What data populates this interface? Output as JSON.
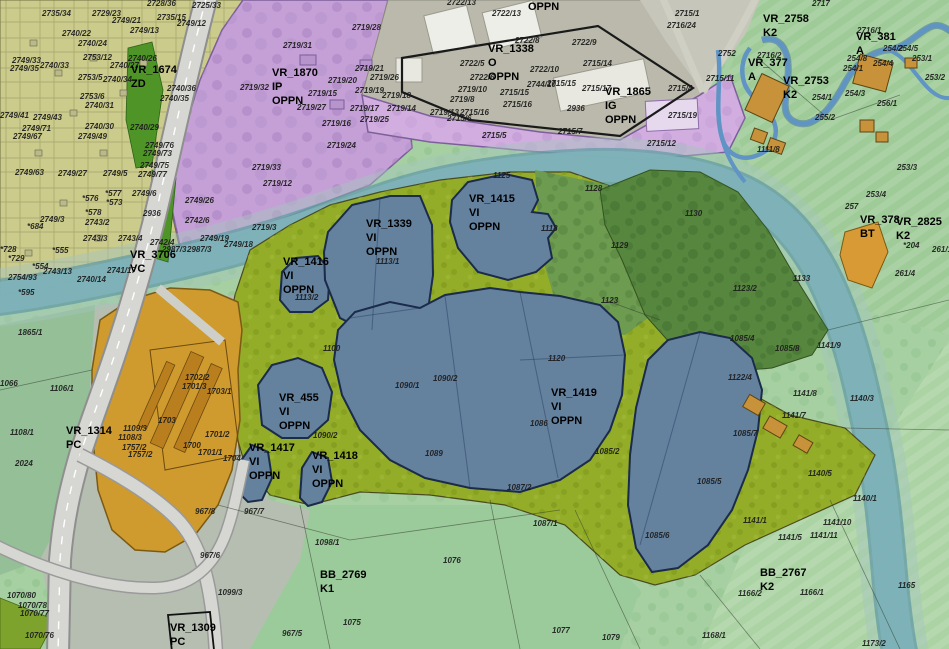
{
  "map_type": "municipal zoning / cadastral plan with land-use zones, gravel-pit lakes, river and highway",
  "colors": {
    "residential_yellow": "#cbcb8c",
    "industrial_purple": "#c4a0d6",
    "industrial_light_purple": "#d2aee0",
    "industrial_gray": "#bab9ab",
    "lake_blue": "#64819e",
    "lake_border": "#1b2b4a",
    "river_teal": "#7fb2ba",
    "recultivation_olive": "#93ad28",
    "forest_dark": "#57863f",
    "quarry_orange": "#cf9a2e",
    "fields_green": "#a6cfa2",
    "green_strip": "#4e9427",
    "road_gray": "#d6d6d2",
    "buildings_tan": "#c8923a"
  },
  "planning_units": [
    {
      "code": "VR_1674",
      "designation": "ZD"
    },
    {
      "code": "VR_3706",
      "designation": "VC"
    },
    {
      "code": "VR_1870",
      "designation": "IP OPPN"
    },
    {
      "code": "VR_1338",
      "designation": "O OPPN"
    },
    {
      "code": "VR_1865",
      "designation": "IG OPPN"
    },
    {
      "code": "VR_2758",
      "designation": "K2"
    },
    {
      "code": "VR_381",
      "designation": "A"
    },
    {
      "code": "VR_377",
      "designation": "A"
    },
    {
      "code": "VR_2753",
      "designation": "K2"
    },
    {
      "code": "VR_378",
      "designation": "BT"
    },
    {
      "code": "VR_2825",
      "designation": "K2"
    },
    {
      "code": "VR_1416",
      "designation": "VI OPPN"
    },
    {
      "code": "VR_1339",
      "designation": "VI OPPN"
    },
    {
      "code": "VR_1415",
      "designation": "VI OPPN"
    },
    {
      "code": "VR_455",
      "designation": "VI OPPN"
    },
    {
      "code": "VR_1417",
      "designation": "VI OPPN"
    },
    {
      "code": "VR_1418",
      "designation": "VI OPPN"
    },
    {
      "code": "VR_1419",
      "designation": "VI OPPN"
    },
    {
      "code": "VR_1314",
      "designation": "PC"
    },
    {
      "code": "VR_1309",
      "designation": "PC"
    },
    {
      "code": "BB_2769",
      "designation": "K1"
    },
    {
      "code": "BB_2767",
      "designation": "K2"
    }
  ],
  "zone_labels": [
    {
      "lines": [
        "VR_1674",
        "ZD"
      ],
      "x": 131,
      "y": 73
    },
    {
      "lines": [
        "VR_3706",
        "VC"
      ],
      "x": 130,
      "y": 258
    },
    {
      "lines": [
        "VR_1870",
        "IP",
        "OPPN"
      ],
      "x": 272,
      "y": 76
    },
    {
      "lines": [
        "VR_1338",
        "O",
        "OPPN"
      ],
      "x": 488,
      "y": 52
    },
    {
      "lines": [
        "OPPN"
      ],
      "x": 528,
      "y": 10
    },
    {
      "lines": [
        "VR_1865",
        "IG",
        "OPPN"
      ],
      "x": 605,
      "y": 95
    },
    {
      "lines": [
        "VR_2758",
        "K2"
      ],
      "x": 763,
      "y": 22
    },
    {
      "lines": [
        "VR_381",
        "A"
      ],
      "x": 856,
      "y": 40
    },
    {
      "lines": [
        "VR_377",
        "A"
      ],
      "x": 748,
      "y": 66
    },
    {
      "lines": [
        "VR_2753",
        "K2"
      ],
      "x": 783,
      "y": 84
    },
    {
      "lines": [
        "VR_378",
        "BT"
      ],
      "x": 860,
      "y": 223
    },
    {
      "lines": [
        "VR_2825",
        "K2"
      ],
      "x": 896,
      "y": 225
    },
    {
      "lines": [
        "VR_1416",
        "VI",
        "OPPN"
      ],
      "x": 283,
      "y": 265
    },
    {
      "lines": [
        "VR_1339",
        "VI",
        "OPPN"
      ],
      "x": 366,
      "y": 227
    },
    {
      "lines": [
        "VR_1415",
        "VI",
        "OPPN"
      ],
      "x": 469,
      "y": 202
    },
    {
      "lines": [
        "VR_455",
        "VI",
        "OPPN"
      ],
      "x": 279,
      "y": 401
    },
    {
      "lines": [
        "VR_1417",
        "VI",
        "OPPN"
      ],
      "x": 249,
      "y": 451
    },
    {
      "lines": [
        "VR_1418",
        "VI",
        "OPPN"
      ],
      "x": 312,
      "y": 459
    },
    {
      "lines": [
        "VR_1419",
        "VI",
        "OPPN"
      ],
      "x": 551,
      "y": 396
    },
    {
      "lines": [
        "VR_1314",
        "PC"
      ],
      "x": 66,
      "y": 434
    },
    {
      "lines": [
        "VR_1309",
        "PC"
      ],
      "x": 170,
      "y": 631
    },
    {
      "lines": [
        "BB_2769",
        "K1"
      ],
      "x": 320,
      "y": 578
    },
    {
      "lines": [
        "BB_2767",
        "K2"
      ],
      "x": 760,
      "y": 576
    }
  ],
  "parcel_labels": [
    {
      "t": "2728/36",
      "x": 147,
      "y": 6
    },
    {
      "t": "2725/33",
      "x": 192,
      "y": 8
    },
    {
      "t": "2735/34",
      "x": 42,
      "y": 16
    },
    {
      "t": "2729/23",
      "x": 92,
      "y": 16
    },
    {
      "t": "2749/21",
      "x": 112,
      "y": 23
    },
    {
      "t": "2735/15",
      "x": 157,
      "y": 20
    },
    {
      "t": "2749/12",
      "x": 177,
      "y": 26
    },
    {
      "t": "2749/13",
      "x": 130,
      "y": 33
    },
    {
      "t": "2740/22",
      "x": 62,
      "y": 36
    },
    {
      "t": "2740/24",
      "x": 78,
      "y": 46
    },
    {
      "t": "2753/12",
      "x": 83,
      "y": 60
    },
    {
      "t": "2740/26",
      "x": 128,
      "y": 61
    },
    {
      "t": "2740/27",
      "x": 110,
      "y": 68
    },
    {
      "t": "2740/33",
      "x": 40,
      "y": 68
    },
    {
      "t": "2749/33",
      "x": 12,
      "y": 63
    },
    {
      "t": "2749/35",
      "x": 10,
      "y": 71
    },
    {
      "t": "2753/5",
      "x": 78,
      "y": 80
    },
    {
      "t": "2740/34",
      "x": 103,
      "y": 82
    },
    {
      "t": "2740/36",
      "x": 167,
      "y": 91
    },
    {
      "t": "2740/35",
      "x": 160,
      "y": 101
    },
    {
      "t": "2753/6",
      "x": 80,
      "y": 99
    },
    {
      "t": "2740/31",
      "x": 85,
      "y": 108
    },
    {
      "t": "2749/43",
      "x": 33,
      "y": 120
    },
    {
      "t": "2749/41",
      "x": 0,
      "y": 118
    },
    {
      "t": "2740/30",
      "x": 85,
      "y": 129
    },
    {
      "t": "2749/71",
      "x": 22,
      "y": 131
    },
    {
      "t": "2749/67",
      "x": 13,
      "y": 139
    },
    {
      "t": "2749/49",
      "x": 78,
      "y": 139
    },
    {
      "t": "2740/29",
      "x": 130,
      "y": 130
    },
    {
      "t": "2749/76",
      "x": 145,
      "y": 148
    },
    {
      "t": "2749/73",
      "x": 143,
      "y": 156
    },
    {
      "t": "2749/63",
      "x": 15,
      "y": 175
    },
    {
      "t": "2749/27",
      "x": 58,
      "y": 176
    },
    {
      "t": "2749/5",
      "x": 103,
      "y": 176
    },
    {
      "t": "2749/75",
      "x": 140,
      "y": 168
    },
    {
      "t": "2749/77",
      "x": 138,
      "y": 177
    },
    {
      "t": "2749/6",
      "x": 132,
      "y": 196
    },
    {
      "t": "*577",
      "x": 105,
      "y": 196
    },
    {
      "t": "*576",
      "x": 82,
      "y": 201
    },
    {
      "t": "*573",
      "x": 106,
      "y": 205
    },
    {
      "t": "*578",
      "x": 85,
      "y": 215
    },
    {
      "t": "2749/3",
      "x": 40,
      "y": 222
    },
    {
      "t": "*684",
      "x": 27,
      "y": 229
    },
    {
      "t": "2743/2",
      "x": 85,
      "y": 225
    },
    {
      "t": "2743/3",
      "x": 83,
      "y": 241
    },
    {
      "t": "2743/4",
      "x": 118,
      "y": 241
    },
    {
      "t": "2742/4",
      "x": 150,
      "y": 245
    },
    {
      "t": "2936",
      "x": 143,
      "y": 216
    },
    {
      "t": "*555",
      "x": 52,
      "y": 253
    },
    {
      "t": "*728",
      "x": 0,
      "y": 252
    },
    {
      "t": "*729",
      "x": 8,
      "y": 261
    },
    {
      "t": "*554",
      "x": 32,
      "y": 269
    },
    {
      "t": "2741/17",
      "x": 107,
      "y": 273
    },
    {
      "t": "2740/14",
      "x": 77,
      "y": 282
    },
    {
      "t": "2754/93",
      "x": 8,
      "y": 280
    },
    {
      "t": "2743/13",
      "x": 43,
      "y": 274
    },
    {
      "t": "*595",
      "x": 18,
      "y": 295
    },
    {
      "t": "2719/33",
      "x": 252,
      "y": 170
    },
    {
      "t": "2719/12",
      "x": 263,
      "y": 186
    },
    {
      "t": "2749/26",
      "x": 185,
      "y": 203
    },
    {
      "t": "2742/6",
      "x": 185,
      "y": 223
    },
    {
      "t": "2719/3",
      "x": 252,
      "y": 230
    },
    {
      "t": "2749/19",
      "x": 200,
      "y": 241
    },
    {
      "t": "2749/18",
      "x": 224,
      "y": 247
    },
    {
      "t": "2987/3",
      "x": 162,
      "y": 252
    },
    {
      "t": "2987/3",
      "x": 187,
      "y": 252
    },
    {
      "t": "2719/31",
      "x": 283,
      "y": 48
    },
    {
      "t": "2719/32",
      "x": 240,
      "y": 90
    },
    {
      "t": "2719/28",
      "x": 352,
      "y": 30
    },
    {
      "t": "2719/21",
      "x": 355,
      "y": 71
    },
    {
      "t": "2719/26",
      "x": 370,
      "y": 80
    },
    {
      "t": "2719/20",
      "x": 328,
      "y": 83
    },
    {
      "t": "2719/15",
      "x": 308,
      "y": 96
    },
    {
      "t": "2719/19",
      "x": 355,
      "y": 93
    },
    {
      "t": "2719/18",
      "x": 382,
      "y": 98
    },
    {
      "t": "2719/27",
      "x": 297,
      "y": 110
    },
    {
      "t": "2719/17",
      "x": 350,
      "y": 111
    },
    {
      "t": "2719/14",
      "x": 387,
      "y": 111
    },
    {
      "t": "2719/16",
      "x": 322,
      "y": 126
    },
    {
      "t": "2719/25",
      "x": 360,
      "y": 122
    },
    {
      "t": "2719/24",
      "x": 327,
      "y": 148
    },
    {
      "t": "2722/13",
      "x": 447,
      "y": 5
    },
    {
      "t": "2722/13",
      "x": 492,
      "y": 16
    },
    {
      "t": "2722/8",
      "x": 515,
      "y": 43
    },
    {
      "t": "2722/9",
      "x": 572,
      "y": 45
    },
    {
      "t": "2722/5",
      "x": 460,
      "y": 66
    },
    {
      "t": "2722/6",
      "x": 470,
      "y": 80
    },
    {
      "t": "2722/10",
      "x": 530,
      "y": 72
    },
    {
      "t": "2715/14",
      "x": 583,
      "y": 66
    },
    {
      "t": "2715/15",
      "x": 547,
      "y": 86
    },
    {
      "t": "2744/10",
      "x": 527,
      "y": 87
    },
    {
      "t": "2719/10",
      "x": 458,
      "y": 92
    },
    {
      "t": "2719/8",
      "x": 450,
      "y": 102
    },
    {
      "t": "2719/13",
      "x": 430,
      "y": 115
    },
    {
      "t": "2715/16",
      "x": 460,
      "y": 115
    },
    {
      "t": "2715/6",
      "x": 447,
      "y": 121
    },
    {
      "t": "2715/16",
      "x": 503,
      "y": 107
    },
    {
      "t": "2936",
      "x": 567,
      "y": 111
    },
    {
      "t": "2715/5",
      "x": 482,
      "y": 138
    },
    {
      "t": "2715/7",
      "x": 558,
      "y": 134
    },
    {
      "t": "2715/17",
      "x": 582,
      "y": 91
    },
    {
      "t": "2715/15",
      "x": 500,
      "y": 95
    },
    {
      "t": "2715/4",
      "x": 668,
      "y": 91
    },
    {
      "t": "2715/19",
      "x": 668,
      "y": 118
    },
    {
      "t": "2715/12",
      "x": 647,
      "y": 146
    },
    {
      "t": "2715/11",
      "x": 706,
      "y": 81
    },
    {
      "t": "2715/1",
      "x": 675,
      "y": 16
    },
    {
      "t": "2716/24",
      "x": 667,
      "y": 28
    },
    {
      "t": "2717",
      "x": 812,
      "y": 6
    },
    {
      "t": "2716/1",
      "x": 857,
      "y": 33
    },
    {
      "t": "2716/2",
      "x": 757,
      "y": 58
    },
    {
      "t": "2752",
      "x": 718,
      "y": 56
    },
    {
      "t": "254/2",
      "x": 883,
      "y": 51
    },
    {
      "t": "254/5",
      "x": 898,
      "y": 51
    },
    {
      "t": "254/8",
      "x": 847,
      "y": 61
    },
    {
      "t": "254/4",
      "x": 873,
      "y": 66
    },
    {
      "t": "253/1",
      "x": 912,
      "y": 61
    },
    {
      "t": "253/2",
      "x": 925,
      "y": 80
    },
    {
      "t": "254/1",
      "x": 843,
      "y": 71
    },
    {
      "t": "254/3",
      "x": 845,
      "y": 96
    },
    {
      "t": "254/1",
      "x": 812,
      "y": 100
    },
    {
      "t": "256/1",
      "x": 877,
      "y": 106
    },
    {
      "t": "255/2",
      "x": 815,
      "y": 120
    },
    {
      "t": "1111/8",
      "x": 757,
      "y": 152
    },
    {
      "t": "253/3",
      "x": 897,
      "y": 170
    },
    {
      "t": "253/4",
      "x": 866,
      "y": 197
    },
    {
      "t": "257",
      "x": 845,
      "y": 209
    },
    {
      "t": "*204",
      "x": 903,
      "y": 248
    },
    {
      "t": "261/4",
      "x": 895,
      "y": 276
    },
    {
      "t": "261/1",
      "x": 932,
      "y": 252
    },
    {
      "t": "1130",
      "x": 685,
      "y": 216
    },
    {
      "t": "1133",
      "x": 793,
      "y": 281
    },
    {
      "t": "1123/2",
      "x": 733,
      "y": 291
    },
    {
      "t": "1123",
      "x": 601,
      "y": 303
    },
    {
      "t": "1129",
      "x": 611,
      "y": 248
    },
    {
      "t": "1128",
      "x": 585,
      "y": 191
    },
    {
      "t": "1118",
      "x": 541,
      "y": 231
    },
    {
      "t": "1125",
      "x": 493,
      "y": 178
    },
    {
      "t": "1113/1",
      "x": 376,
      "y": 264
    },
    {
      "t": "1113/2",
      "x": 295,
      "y": 300
    },
    {
      "t": "1100",
      "x": 323,
      "y": 351
    },
    {
      "t": "1090/1",
      "x": 395,
      "y": 388
    },
    {
      "t": "1090/2",
      "x": 433,
      "y": 381
    },
    {
      "t": "1120",
      "x": 548,
      "y": 361
    },
    {
      "t": "1086",
      "x": 530,
      "y": 426
    },
    {
      "t": "1089",
      "x": 425,
      "y": 456
    },
    {
      "t": "1090/2",
      "x": 313,
      "y": 438
    },
    {
      "t": "1085/2",
      "x": 595,
      "y": 454
    },
    {
      "t": "1087/2",
      "x": 507,
      "y": 490
    },
    {
      "t": "1122/4",
      "x": 728,
      "y": 380
    },
    {
      "t": "1085/7",
      "x": 733,
      "y": 436
    },
    {
      "t": "1085/5",
      "x": 697,
      "y": 484
    },
    {
      "t": "1085/4",
      "x": 730,
      "y": 341
    },
    {
      "t": "1085/8",
      "x": 775,
      "y": 351
    },
    {
      "t": "1141/9",
      "x": 817,
      "y": 348
    },
    {
      "t": "1141/8",
      "x": 793,
      "y": 396
    },
    {
      "t": "1141/7",
      "x": 782,
      "y": 418
    },
    {
      "t": "1140/3",
      "x": 850,
      "y": 401
    },
    {
      "t": "1140/5",
      "x": 808,
      "y": 476
    },
    {
      "t": "1085/6",
      "x": 645,
      "y": 538
    },
    {
      "t": "1140/1",
      "x": 853,
      "y": 501
    },
    {
      "t": "1141/10",
      "x": 823,
      "y": 525
    },
    {
      "t": "1141/5",
      "x": 778,
      "y": 540
    },
    {
      "t": "1141/11",
      "x": 810,
      "y": 538
    },
    {
      "t": "1141/1",
      "x": 743,
      "y": 523
    },
    {
      "t": "1166/2",
      "x": 738,
      "y": 596
    },
    {
      "t": "1166/1",
      "x": 800,
      "y": 595
    },
    {
      "t": "1165",
      "x": 898,
      "y": 588
    },
    {
      "t": "1168/1",
      "x": 702,
      "y": 638
    },
    {
      "t": "1173/2",
      "x": 862,
      "y": 646
    },
    {
      "t": "1098/1",
      "x": 315,
      "y": 545
    },
    {
      "t": "1076",
      "x": 443,
      "y": 563
    },
    {
      "t": "1075",
      "x": 343,
      "y": 625
    },
    {
      "t": "1087/1",
      "x": 533,
      "y": 526
    },
    {
      "t": "1077",
      "x": 552,
      "y": 633
    },
    {
      "t": "1079",
      "x": 602,
      "y": 640
    },
    {
      "t": "967/8",
      "x": 195,
      "y": 514
    },
    {
      "t": "967/7",
      "x": 244,
      "y": 514
    },
    {
      "t": "967/6",
      "x": 200,
      "y": 558
    },
    {
      "t": "1099/3",
      "x": 218,
      "y": 595
    },
    {
      "t": "967/5",
      "x": 282,
      "y": 636
    },
    {
      "t": "1070/80",
      "x": 7,
      "y": 598
    },
    {
      "t": "1070/78",
      "x": 18,
      "y": 608
    },
    {
      "t": "1070/77",
      "x": 20,
      "y": 616
    },
    {
      "t": "1070/76",
      "x": 25,
      "y": 638
    },
    {
      "t": "1865/1",
      "x": 18,
      "y": 335
    },
    {
      "t": "1106/1",
      "x": 50,
      "y": 391
    },
    {
      "t": "1108/1",
      "x": 10,
      "y": 435
    },
    {
      "t": "2024",
      "x": 15,
      "y": 466
    },
    {
      "t": "1066",
      "x": 0,
      "y": 386
    },
    {
      "t": "1702/2",
      "x": 185,
      "y": 380
    },
    {
      "t": "1701/3",
      "x": 182,
      "y": 389
    },
    {
      "t": "1703/1",
      "x": 207,
      "y": 394
    },
    {
      "t": "1703",
      "x": 158,
      "y": 423
    },
    {
      "t": "1700",
      "x": 183,
      "y": 448
    },
    {
      "t": "1701/2",
      "x": 205,
      "y": 437
    },
    {
      "t": "1701/1",
      "x": 198,
      "y": 455
    },
    {
      "t": "1704",
      "x": 223,
      "y": 461
    },
    {
      "t": "1109/3",
      "x": 123,
      "y": 431
    },
    {
      "t": "1108/3",
      "x": 118,
      "y": 440
    },
    {
      "t": "1757/2",
      "x": 122,
      "y": 450
    },
    {
      "t": "1757/2",
      "x": 128,
      "y": 457
    }
  ]
}
